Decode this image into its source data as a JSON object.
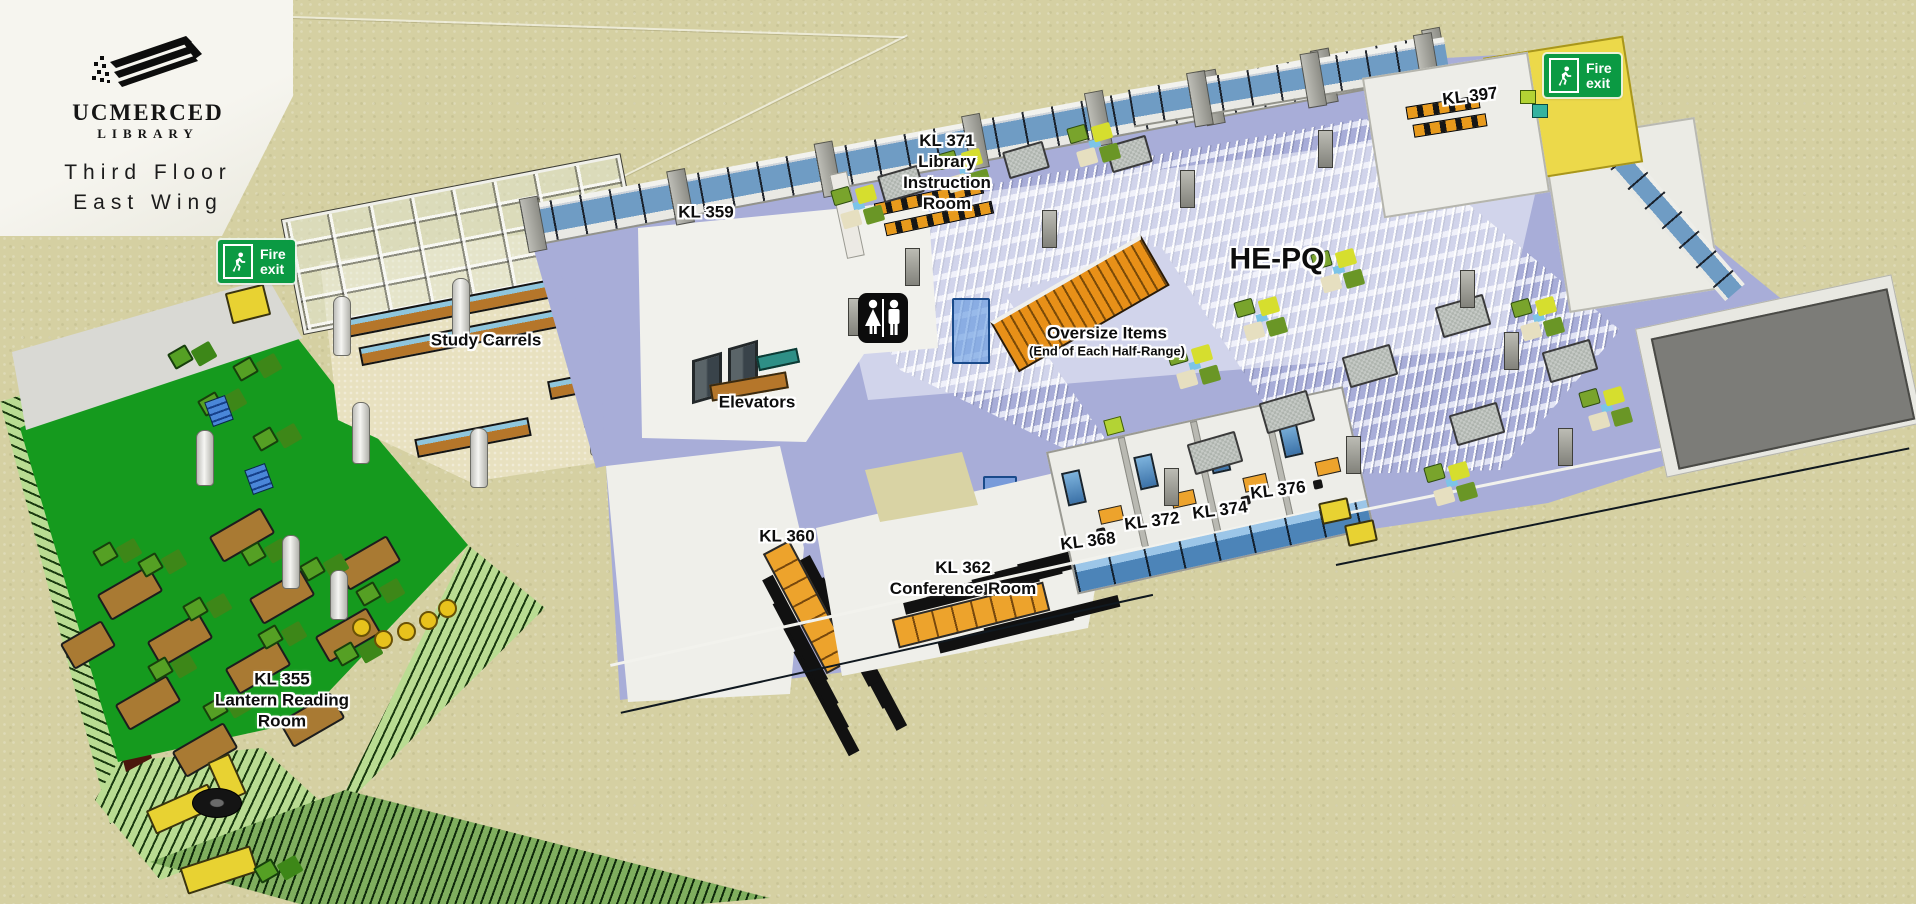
{
  "branding": {
    "name": "UCMERCED",
    "sub": "LIBRARY"
  },
  "title": {
    "line1": "Third Floor",
    "line2": "East Wing"
  },
  "signs": {
    "fire": {
      "line1": "Fire",
      "line2": "exit"
    },
    "restroom": "restroom"
  },
  "labels": {
    "kl359": "KL 359",
    "kl371_line1": "KL 371",
    "kl371_line2": "Library",
    "kl371_line3": "Instruction",
    "kl371_line4": "Room",
    "kl397": "KL 397",
    "hepq": "HE-PQ",
    "oversize_line1": "Oversize Items",
    "oversize_line2": "(End of Each Half-Range)",
    "elevators": "Elevators",
    "study_carrels": "Study Carrels",
    "kl355_line1": "KL 355",
    "kl355_line2": "Lantern Reading",
    "kl355_line3": "Room",
    "kl360": "KL 360",
    "kl362_line1": "KL 362",
    "kl362_line2": "Conference Room",
    "kl368": "KL 368",
    "kl372": "KL 372",
    "kl374": "KL 374",
    "kl376": "KL 376"
  },
  "colors": {
    "background": "#d5d0a2",
    "floor": "#a8add8",
    "reading_room_green": "#159a1e",
    "fire_sign_green": "#0b9a43",
    "stair_lobby_yellow": "#ecd94a",
    "window_glass_blue": "#4c84b8",
    "roof_gray": "#7c7c78",
    "table_orange": "#eda32c",
    "carrel_floor_tan": "#e8e1c0"
  }
}
